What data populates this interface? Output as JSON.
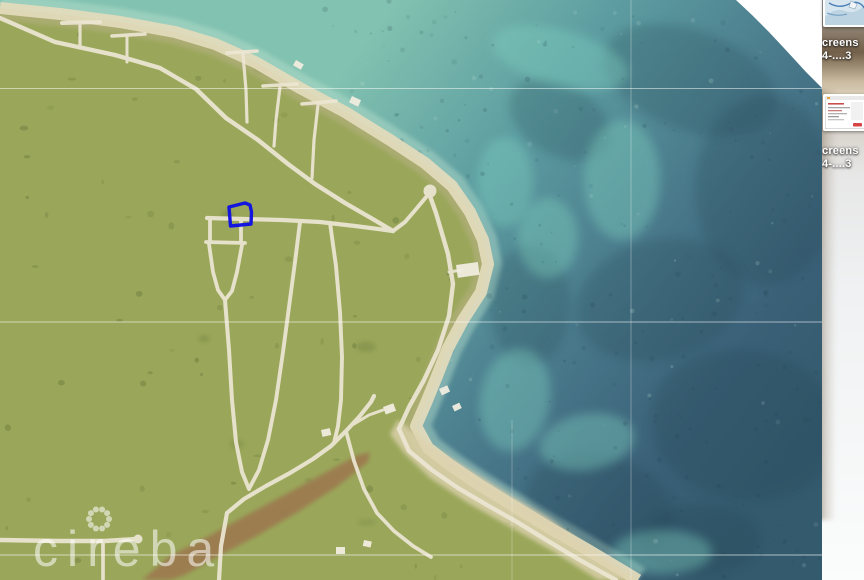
{
  "desktop": {
    "icons": [
      {
        "name": "screenshot-file-1",
        "label_lines": [
          "creens",
          "4-....3"
        ],
        "thumb_type": "map-preview"
      },
      {
        "name": "screenshot-file-2",
        "label_lines": [
          "creens",
          "4-....3"
        ],
        "thumb_type": "window-preview"
      }
    ]
  },
  "map": {
    "watermark": {
      "text": "cireba",
      "x": 33,
      "y": 566,
      "font_size": 50,
      "letter_spacing": 9,
      "opacity": 0.55,
      "flower": {
        "cx": 99,
        "cy": 519,
        "ring_r": 10,
        "petals": 10,
        "petal_r": 3
      }
    },
    "colors": {
      "land": "#9aa75a",
      "land_dark": "#53652e",
      "ocean_near": "#82c2b0",
      "ocean_mid1": "#5d9da1",
      "ocean_mid2": "#49798b",
      "ocean_deep": "#3a6077",
      "ocean_deepest": "#345a6e",
      "reef_dark": "#22424f",
      "reef_bright": "#7fd0c0",
      "shallow_pale": "#b9e0cf",
      "beach": "#e4dbbc",
      "ridge": "#bfb28e",
      "road": "#ece6d3",
      "lagoon": "#9c7a50",
      "building": "#f0ecdf",
      "lot_stroke": "#1515e0",
      "grid": "#ffffff",
      "photo_bg": "#ffffff"
    },
    "coast": [
      [
        0,
        8
      ],
      [
        60,
        14
      ],
      [
        120,
        22
      ],
      [
        175,
        32
      ],
      [
        215,
        44
      ],
      [
        255,
        62
      ],
      [
        300,
        88
      ],
      [
        345,
        112
      ],
      [
        390,
        140
      ],
      [
        425,
        163
      ],
      [
        452,
        186
      ],
      [
        470,
        212
      ],
      [
        483,
        240
      ],
      [
        488,
        264
      ],
      [
        481,
        292
      ],
      [
        463,
        320
      ],
      [
        448,
        348
      ],
      [
        437,
        376
      ],
      [
        426,
        403
      ],
      [
        416,
        426
      ],
      [
        428,
        448
      ],
      [
        450,
        465
      ],
      [
        478,
        484
      ],
      [
        512,
        505
      ],
      [
        548,
        527
      ],
      [
        588,
        550
      ],
      [
        625,
        572
      ],
      [
        638,
        580
      ]
    ],
    "photo_wedge": [
      [
        736,
        0
      ],
      [
        822,
        0
      ],
      [
        822,
        88
      ],
      [
        817,
        83
      ],
      [
        806,
        72
      ],
      [
        795,
        60
      ],
      [
        783,
        47
      ],
      [
        768,
        31
      ],
      [
        752,
        15
      ]
    ],
    "lagoon": [
      [
        142,
        580
      ],
      [
        170,
        556
      ],
      [
        205,
        538
      ],
      [
        245,
        516
      ],
      [
        288,
        493
      ],
      [
        330,
        470
      ],
      [
        358,
        455
      ],
      [
        370,
        452
      ],
      [
        368,
        462
      ],
      [
        338,
        486
      ],
      [
        298,
        512
      ],
      [
        255,
        537
      ],
      [
        215,
        558
      ],
      [
        185,
        575
      ],
      [
        170,
        580
      ]
    ],
    "sand_cove": [
      [
        398,
        420
      ],
      [
        432,
        446
      ],
      [
        472,
        471
      ],
      [
        512,
        496
      ],
      [
        548,
        517
      ],
      [
        588,
        547
      ],
      [
        622,
        571
      ],
      [
        638,
        580
      ],
      [
        598,
        580
      ],
      [
        556,
        553
      ],
      [
        512,
        528
      ],
      [
        468,
        503
      ],
      [
        430,
        478
      ],
      [
        404,
        453
      ],
      [
        390,
        434
      ]
    ],
    "roads": [
      {
        "name": "main-shore-road",
        "w": 4.4,
        "pts": [
          [
            0,
            18
          ],
          [
            55,
            42
          ],
          [
            115,
            55
          ],
          [
            160,
            68
          ],
          [
            196,
            89
          ],
          [
            226,
            118
          ],
          [
            258,
            140
          ],
          [
            288,
            164
          ],
          [
            315,
            184
          ],
          [
            345,
            203
          ],
          [
            371,
            218
          ],
          [
            393,
            231
          ]
        ]
      },
      {
        "name": "lollipop-stem",
        "w": 4.0,
        "pts": [
          [
            393,
            231
          ],
          [
            405,
            222
          ],
          [
            417,
            208
          ],
          [
            427,
            196
          ]
        ]
      },
      {
        "name": "coastal-road",
        "w": 4.4,
        "pts": [
          [
            430,
            196
          ],
          [
            436,
            213
          ],
          [
            448,
            254
          ],
          [
            453,
            284
          ],
          [
            449,
            316
          ],
          [
            438,
            350
          ],
          [
            424,
            380
          ],
          [
            409,
            407
          ],
          [
            399,
            429
          ],
          [
            409,
            451
          ],
          [
            432,
            470
          ],
          [
            458,
            488
          ],
          [
            487,
            505
          ],
          [
            517,
            522
          ],
          [
            548,
            541
          ],
          [
            578,
            559
          ],
          [
            605,
            574
          ],
          [
            616,
            580
          ]
        ]
      },
      {
        "name": "cross-road",
        "w": 4.2,
        "pts": [
          [
            393,
            231
          ],
          [
            355,
            226
          ],
          [
            320,
            222
          ],
          [
            282,
            220
          ],
          [
            244,
            219
          ],
          [
            207,
            218
          ]
        ]
      },
      {
        "name": "keyhole-west",
        "w": 3.8,
        "pts": [
          [
            210,
            220
          ],
          [
            210,
            242
          ]
        ]
      },
      {
        "name": "keyhole-east",
        "w": 3.8,
        "pts": [
          [
            241,
            221
          ],
          [
            241,
            243
          ]
        ]
      },
      {
        "name": "keyhole-bar",
        "w": 3.8,
        "pts": [
          [
            206,
            242
          ],
          [
            245,
            243
          ]
        ]
      },
      {
        "name": "keyhole-funnel",
        "w": 3.8,
        "pts": [
          [
            209,
            244
          ],
          [
            213,
            272
          ],
          [
            218,
            290
          ],
          [
            225,
            300
          ],
          [
            232,
            291
          ],
          [
            237,
            272
          ],
          [
            242,
            245
          ]
        ]
      },
      {
        "name": "keyhole-stem",
        "w": 4.0,
        "pts": [
          [
            225,
            300
          ],
          [
            229,
            350
          ],
          [
            232,
            400
          ],
          [
            236,
            442
          ],
          [
            242,
            472
          ],
          [
            249,
            489
          ]
        ]
      },
      {
        "name": "diagonal-a",
        "w": 3.9,
        "pts": [
          [
            300,
            222
          ],
          [
            295,
            262
          ],
          [
            289,
            307
          ],
          [
            283,
            352
          ],
          [
            276,
            400
          ],
          [
            268,
            440
          ],
          [
            259,
            470
          ],
          [
            250,
            487
          ]
        ]
      },
      {
        "name": "diagonal-b",
        "w": 3.9,
        "pts": [
          [
            330,
            223
          ],
          [
            336,
            266
          ],
          [
            340,
            312
          ],
          [
            342,
            357
          ],
          [
            341,
            400
          ],
          [
            338,
            426
          ],
          [
            334,
            443
          ]
        ]
      },
      {
        "name": "lagoon-road",
        "w": 4.2,
        "pts": [
          [
            219,
            580
          ],
          [
            221,
            546
          ],
          [
            227,
            513
          ],
          [
            244,
            499
          ],
          [
            266,
            486
          ],
          [
            290,
            473
          ],
          [
            313,
            459
          ],
          [
            331,
            446
          ],
          [
            346,
            431
          ],
          [
            359,
            417
          ],
          [
            371,
            402
          ],
          [
            374,
            396
          ]
        ]
      },
      {
        "name": "beach-branch",
        "w": 3.7,
        "pts": [
          [
            346,
            431
          ],
          [
            354,
            461
          ],
          [
            364,
            489
          ],
          [
            377,
            513
          ],
          [
            394,
            531
          ],
          [
            413,
            546
          ],
          [
            431,
            557
          ]
        ]
      },
      {
        "name": "house-stub",
        "w": 3.0,
        "pts": [
          [
            354,
            424
          ],
          [
            369,
            415
          ],
          [
            383,
            410
          ]
        ]
      },
      {
        "name": "bottom-road",
        "w": 4.4,
        "pts": [
          [
            0,
            540
          ],
          [
            60,
            541
          ],
          [
            105,
            541
          ],
          [
            136,
            539
          ]
        ]
      },
      {
        "name": "bottom-stub",
        "w": 3.7,
        "pts": [
          [
            103,
            542
          ],
          [
            103,
            579
          ]
        ]
      },
      {
        "name": "t-a-bar",
        "w": 4.0,
        "pts": [
          [
            62,
            23
          ],
          [
            100,
            22
          ]
        ]
      },
      {
        "name": "t-a-stem",
        "w": 3.2,
        "pts": [
          [
            80,
            24
          ],
          [
            80,
            48
          ]
        ]
      },
      {
        "name": "t-b-bar",
        "w": 3.6,
        "pts": [
          [
            112,
            36
          ],
          [
            145,
            34
          ]
        ]
      },
      {
        "name": "t-b-stem",
        "w": 3.0,
        "pts": [
          [
            127,
            37
          ],
          [
            127,
            62
          ]
        ]
      },
      {
        "name": "t-c-bar",
        "w": 3.6,
        "pts": [
          [
            227,
            53
          ],
          [
            257,
            51
          ]
        ]
      },
      {
        "name": "t-c-stem",
        "w": 3.2,
        "pts": [
          [
            243,
            54
          ],
          [
            246,
            90
          ],
          [
            247,
            122
          ]
        ]
      },
      {
        "name": "t-d-bar",
        "w": 3.6,
        "pts": [
          [
            263,
            86
          ],
          [
            297,
            84
          ]
        ]
      },
      {
        "name": "t-d-stem",
        "w": 3.2,
        "pts": [
          [
            280,
            87
          ],
          [
            276,
            120
          ],
          [
            274,
            146
          ]
        ]
      },
      {
        "name": "t-e-bar",
        "w": 3.6,
        "pts": [
          [
            302,
            104
          ],
          [
            336,
            101
          ]
        ]
      },
      {
        "name": "t-e-stem",
        "w": 3.2,
        "pts": [
          [
            318,
            105
          ],
          [
            314,
            140
          ],
          [
            312,
            178
          ]
        ]
      },
      {
        "name": "ne-spur",
        "w": 3.0,
        "pts": [
          [
            449,
            272
          ],
          [
            462,
            270
          ]
        ]
      }
    ],
    "road_circles": [
      [
        430,
        191,
        6.5
      ],
      [
        138,
        539,
        4.5
      ]
    ],
    "buildings": [
      [
        383,
        407,
        11,
        8,
        -20
      ],
      [
        321,
        430,
        9,
        7,
        -12
      ],
      [
        336,
        547,
        9,
        7,
        0
      ],
      [
        364,
        540,
        8,
        6,
        12
      ],
      [
        439,
        389,
        9,
        7,
        -25
      ],
      [
        452,
        406,
        8,
        6,
        -25
      ],
      [
        456,
        265,
        22,
        13,
        -8
      ],
      [
        296,
        60,
        9,
        6,
        30
      ],
      [
        352,
        96,
        10,
        7,
        25
      ]
    ],
    "reef_patches": [
      [
        690,
        80,
        90,
        50,
        20
      ],
      [
        765,
        190,
        70,
        95,
        0
      ],
      [
        660,
        300,
        85,
        60,
        -15
      ],
      [
        745,
        425,
        95,
        75,
        10
      ],
      [
        600,
        505,
        75,
        50,
        15
      ],
      [
        560,
        120,
        55,
        35,
        30
      ],
      [
        530,
        305,
        40,
        60,
        0
      ],
      [
        700,
        540,
        60,
        35,
        0
      ]
    ],
    "bright_patches": [
      [
        560,
        58,
        70,
        28,
        15
      ],
      [
        622,
        180,
        38,
        60,
        0
      ],
      [
        515,
        400,
        35,
        52,
        10
      ],
      [
        587,
        442,
        48,
        28,
        -10
      ],
      [
        662,
        552,
        50,
        22,
        0
      ],
      [
        505,
        182,
        28,
        45,
        0
      ],
      [
        548,
        238,
        30,
        40,
        0
      ],
      [
        470,
        530,
        40,
        24,
        -15
      ]
    ],
    "graticule": {
      "horizontal": [
        {
          "y": 88.5,
          "opacity": 0.5
        },
        {
          "y": 322,
          "opacity": 0.55
        },
        {
          "y": 555,
          "opacity": 0.6
        }
      ],
      "vertical": [
        {
          "x": 631,
          "y1": 0,
          "y2": 580,
          "opacity": 0.3
        },
        {
          "x": 512,
          "y1": 420,
          "y2": 580,
          "opacity": 0.25
        }
      ]
    },
    "lot_marker": {
      "stroke_width": 3.4,
      "pts": [
        [
          229,
          207
        ],
        [
          245,
          203
        ],
        [
          250,
          205
        ],
        [
          251.5,
          212
        ],
        [
          251,
          224
        ],
        [
          230.5,
          226
        ]
      ]
    }
  }
}
